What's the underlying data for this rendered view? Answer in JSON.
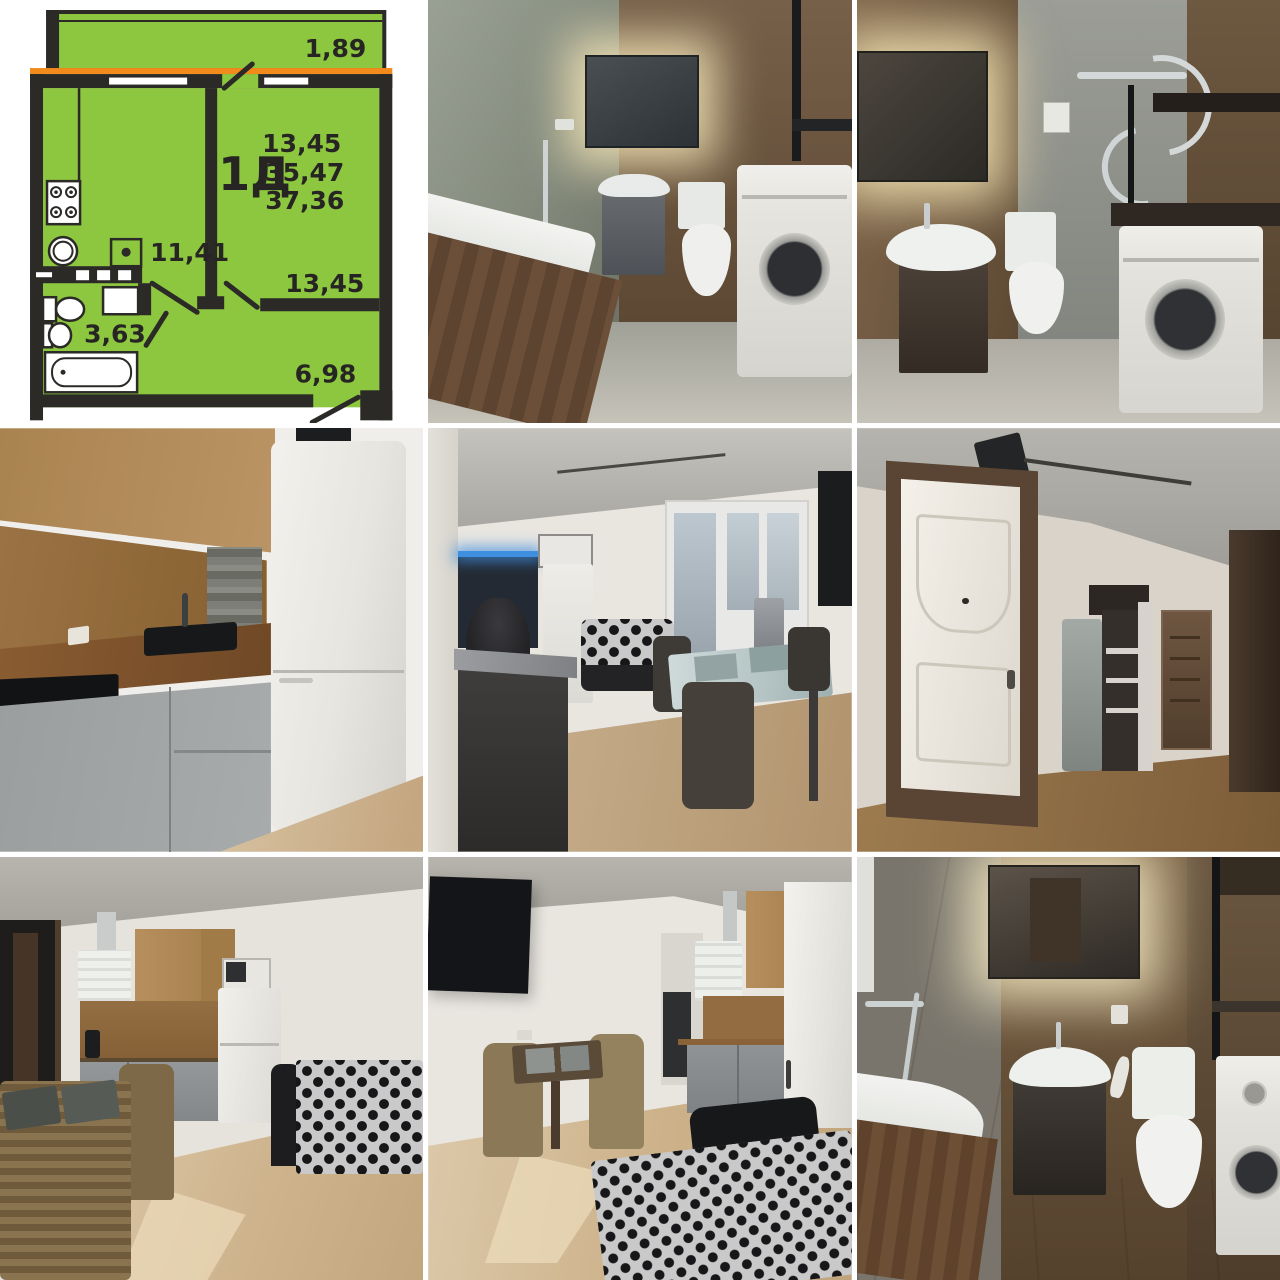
{
  "floor_plan": {
    "unit_label": "1Д",
    "areas": {
      "header_room": "13,45",
      "living": "35,47",
      "total": "37,36",
      "balcony": "1,89",
      "kitchen": "11,41",
      "room": "13,45",
      "bathroom": "3,63",
      "hallway": "6,98"
    },
    "colors": {
      "plan_green": "#8dc63f",
      "wall_dark": "#2b2a27",
      "balcony_divider_orange": "#f28a1c",
      "label_text": "#262523"
    }
  },
  "photos": [
    {
      "id": "bathroom-1",
      "alt": "Bathroom with bathtub, backlit mirror, grey vanity with sink, toilet and washing machine"
    },
    {
      "id": "bathroom-2",
      "alt": "Bathroom with backlit mirror, sink on dark vanity, toilet, chrome towel rail and washing machine under dark counter"
    },
    {
      "id": "kitchen",
      "alt": "Corner kitchen with wooden worktop and backsplash, black sink, induction hob, grey lower cabinets and white fridge"
    },
    {
      "id": "living-room-1",
      "alt": "Room with dark kitchen unit, black sofa, glass dining table with wicker chairs, balcony door and wall TV"
    },
    {
      "id": "hallway",
      "alt": "Hallway with white entrance door, fabric wardrobe with open shelving and dark interior doors"
    },
    {
      "id": "living-room-2",
      "alt": "Studio room with corner kitchen, white fridge with microwave, patterned sofa and wicker dining table"
    },
    {
      "id": "living-room-3",
      "alt": "Studio room with wall TV, wicker dining set, kitchenette with white fridge and patterned sofa bed"
    },
    {
      "id": "bathroom-3",
      "alt": "Bathroom with bathtub, backlit mirror, dark vanity with white sink, toilet and washing machine"
    }
  ]
}
